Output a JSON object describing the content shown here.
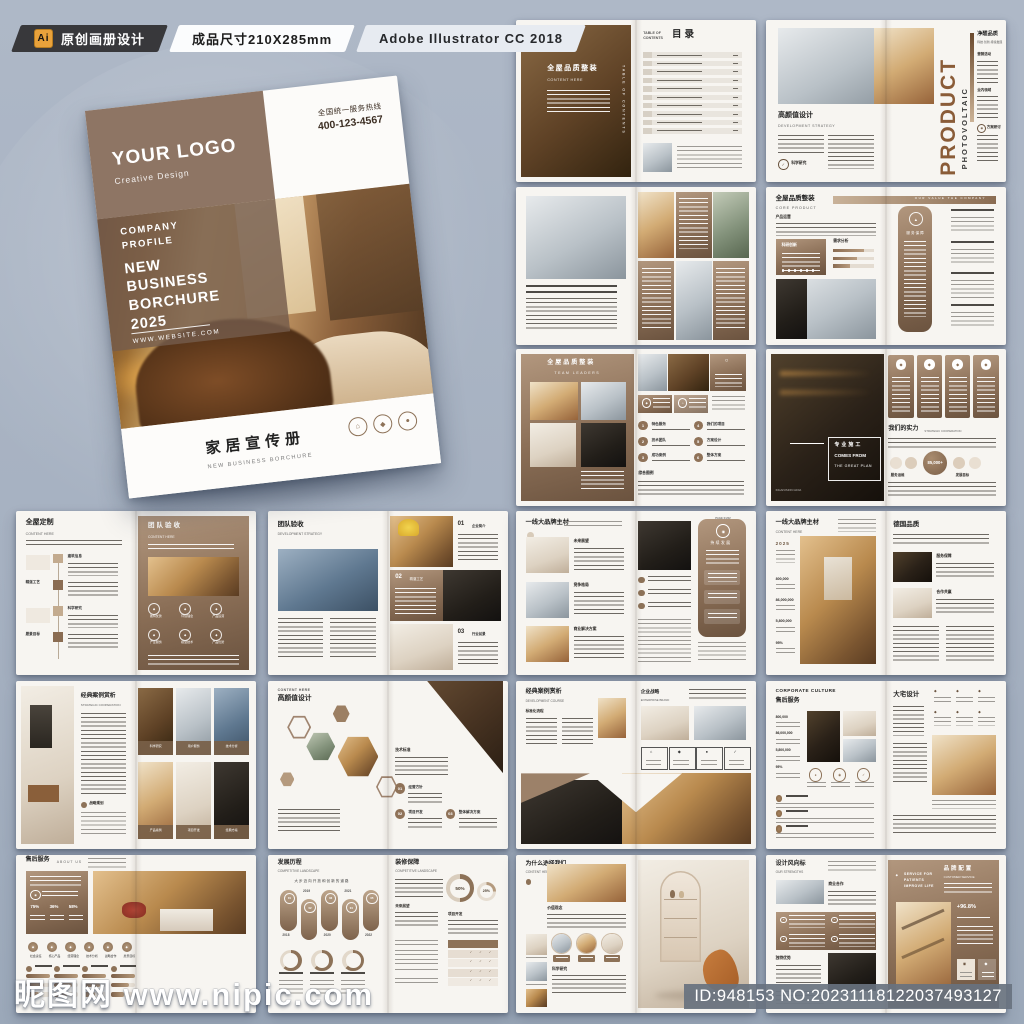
{
  "toolbar": {
    "badge": "Ai",
    "item1": "原创画册设计",
    "item2": "成品尺寸210X285mm",
    "item3": "Adobe Illustrator CC 2018"
  },
  "watermark": {
    "site_cn": "昵图网",
    "site_url": "www.nipic.com",
    "id_text": "ID:948153 NO:20231118122037493127"
  },
  "cover": {
    "logo": "YOUR LOGO",
    "logo_sub": "Creative Design",
    "hotline_label": "全国统一服务热线",
    "hotline_number": "400-123-4567",
    "company_label": "COMPANY\nPROFILE",
    "main_title": "NEW\nBUSINESS\nBORCHURE\n2025",
    "website": "WWW.WEBSITE.COM",
    "bottom_cn": "家居宣传册",
    "bottom_en": "NEW BUSINESS BORCHURE"
  },
  "icons": {
    "quote": "“",
    "house": "⌂",
    "diamond": "◆",
    "dot": "●",
    "ring": "○",
    "triangle": "▲",
    "check": "✓",
    "target": "◉"
  },
  "colors": {
    "accent": "#8d7158",
    "accent_dark": "#6f563f",
    "accent_light": "#b59a7e",
    "paper": "#f7f5f1",
    "bar_dark": "#38383b",
    "badge_orange": "#e9a23b"
  },
  "spreads": [
    {
      "n": "contents",
      "title_cn": "全屋品质整装",
      "title_en": "CONTENT HERE",
      "vertical": "TABLE OF CONTENTS",
      "kicker": "TABLE OF\nCONTENTS",
      "title": "目录"
    },
    {
      "n": "product",
      "title_cn": "高颜值设计",
      "title_en": "DEVELOPMENT STRATEGY",
      "icon_label": "科学研究",
      "big_word": "PRODUCT",
      "vertical_word": "PHOTOVOLTAIC",
      "r_title": "净醛品质",
      "r_sub": "科技·创新·持续发展",
      "sections": [
        "营销活动",
        "业内领域",
        "方案研讨"
      ]
    },
    {
      "n": "cases-collage"
    },
    {
      "n": "core-product",
      "title_cn": "全屋品质整装",
      "title_en": "CORE PRODUCT",
      "banner": "OUR VALUE THE COMPANY",
      "label1": "产品运营",
      "box_label": "科研创新",
      "chart_label": "需求分析",
      "panel_label": "服务保障"
    },
    {
      "n": "team-leaders",
      "title_cn": "全屋品质整装",
      "title_en": "TEAM LEADERS",
      "items": [
        "特色服务",
        "技术团队",
        "成功案例",
        "我们的项目",
        "方案设计",
        "整体方案"
      ],
      "footer_label": "综合图例"
    },
    {
      "n": "strength",
      "o1": "专业施工",
      "o2": "COMES FROM",
      "o3": "THE GREAT PLAN",
      "caption": "INGAIVISION GIOIA",
      "r_title": "我们的实力",
      "r_sub": "STRATEGIC COOPERATION",
      "stat": "85,000+",
      "lab1": "服务运维",
      "lab2": "发展目标"
    },
    {
      "n": "custom",
      "title_cn": "全屋定制",
      "title_en": "CONTENT HERE",
      "timeline": [
        "建筑信息",
        "精湛工艺",
        "科学研究",
        "愿景目标"
      ],
      "r_title": "团队验收",
      "r_sub": "CONTENT HERE",
      "icon_labels": [
        "独特优势",
        "环境理念",
        "产品运营",
        "产业服务",
        "模型技术",
        "产品优势"
      ]
    },
    {
      "n": "acceptance",
      "title_cn": "团队验收",
      "title_en": "DEVELOPMENT STRATEGY",
      "nums": [
        "01",
        "02",
        "03"
      ],
      "num_labels": [
        "企业简介",
        "精湛工艺",
        "行业前景"
      ]
    },
    {
      "n": "materials-1",
      "title_cn": "一线大品牌主材",
      "page_marker": "PAGE 01/02",
      "labels": [
        "未来展望",
        "竞争格局",
        "商业解决方案"
      ],
      "panel_label": "持续发展"
    },
    {
      "n": "materials-2",
      "title_cn": "一线大品牌主材",
      "title_en": "CONTENT HERE",
      "year": "2025",
      "stats": [
        "800,000",
        "86,000,000",
        "5,800,000",
        "95%"
      ],
      "r_title": "德国品质",
      "labels": [
        "服务保障",
        "合作共赢"
      ]
    },
    {
      "n": "classic-cases",
      "title_cn": "经典案例赏析",
      "title_en": "STRATEGIC COOPERATION",
      "tag": "战略规划",
      "cards": [
        "科学研究",
        "产品案例",
        "用户服务",
        "项目开发",
        "技术分析",
        "经典方案"
      ]
    },
    {
      "n": "hi-design",
      "kicker": "CONTENT HERE",
      "title_cn": "高颜值设计",
      "label": "技术标准",
      "nums": [
        "01",
        "02",
        "03"
      ],
      "num_labels": [
        "经营方针",
        "项目开发",
        "整体解决方案"
      ]
    },
    {
      "n": "course",
      "title_cn": "经典案例赏析",
      "title_en": "DEVELOPMENT COURSE",
      "label": "标准化流程",
      "r_title": "企业战略",
      "r_sub": "ENTERPRISE BRAND"
    },
    {
      "n": "culture",
      "title_en": "CORPORATE CULTURE",
      "title_cn": "售后服务",
      "stats": [
        "800,000",
        "86,000,000",
        "5,800,000",
        "95%"
      ],
      "r_title": "大宅设计"
    },
    {
      "n": "about",
      "title_cn": "售后服务",
      "title_en": "ABOUT US",
      "pcts": [
        "75%",
        "36%",
        "58%"
      ],
      "icon_labels": [
        "社会责任",
        "核心产品",
        "经营理念",
        "技术分析",
        "战略合作",
        "愿景目标"
      ]
    },
    {
      "n": "history",
      "title_cn": "发展历程",
      "title_en": "COMPETITIVE LANDSCAPE",
      "subtitle": "大步迈向开放和创新的道路",
      "years": [
        "2018",
        "2019",
        "2020",
        "2021",
        "2022"
      ],
      "nums": [
        "01",
        "02",
        "03",
        "04",
        "05"
      ],
      "r_title": "装修保障",
      "r_sub": "COMPETITIVE LANDSCAPE",
      "r_lab1": "未来展望",
      "pcts": [
        "50%",
        "25%"
      ],
      "r_lab2": "项目开发"
    },
    {
      "n": "why-us",
      "title_cn": "为什么选择我们",
      "title_en": "CONTENT HERE",
      "page_marker": "01 / 02",
      "labels": [
        "价值观念",
        "科学研究"
      ]
    },
    {
      "n": "style",
      "title_cn": "设计风向标",
      "title_en": "OUR STRENGTHS",
      "labels": [
        "商业合作",
        "独特优势"
      ],
      "r_title": "品牌配置",
      "r_sub": "CUSTOMER SERVICE",
      "slogan": "SERVICE FOR\nPATIENTS\nIMPROVE LIFE",
      "stat": "+96.8%"
    }
  ]
}
